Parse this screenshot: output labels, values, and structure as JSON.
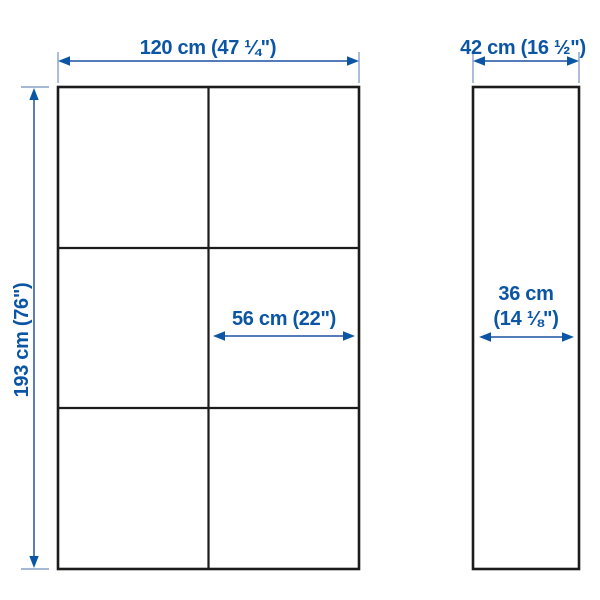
{
  "diagram": {
    "type": "furniture-dimension-diagram",
    "front_view": {
      "width_label": "120 cm (47 ¼\")",
      "height_label": "193 cm (76\")",
      "section_width_label": "56 cm (22\")",
      "grid": {
        "columns": 2,
        "rows": 3
      }
    },
    "side_view": {
      "depth_label": "42 cm (16 ½\")",
      "inner_depth_label_line1": "36 cm",
      "inner_depth_label_line2": "(14 ⅛\")"
    },
    "colors": {
      "label_blue": "#0b55a5",
      "dimension_line_blue": "#3c68b0",
      "extension_line_blue": "#8aa0c9",
      "outline_black": "#1c1c1c",
      "background": "#ffffff"
    }
  }
}
